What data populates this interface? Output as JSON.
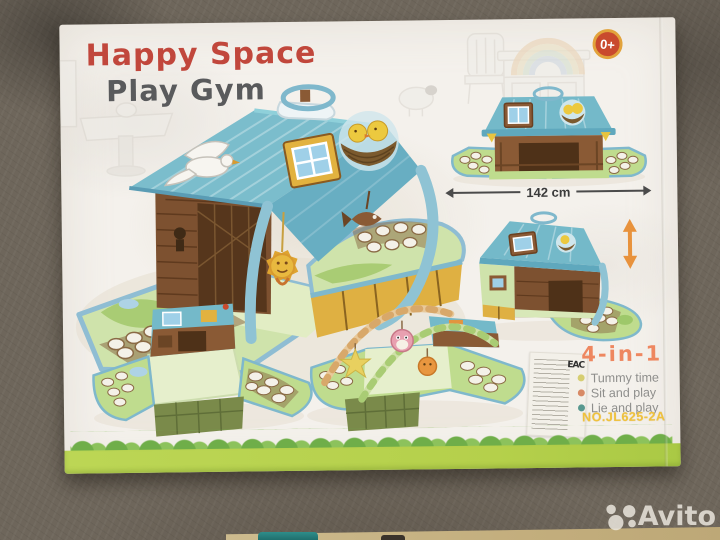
{
  "photo": {
    "watermark_label": "Avito",
    "surface_colors": {
      "carpet": "#6e665b",
      "wood_floor": "#c6b284"
    }
  },
  "box_front": {
    "brand_title": "Happy Space",
    "product_title": "Play Gym",
    "age_badge": "0+",
    "size_label": "142 cm",
    "multi_use_heading": "4-in-1",
    "features": [
      {
        "label": "Tummy time",
        "bullet_color": "#d6ce72"
      },
      {
        "label": "Sit and play",
        "bullet_color": "#d88a66"
      },
      {
        "label": "Lie and play",
        "bullet_color": "#58988f"
      }
    ],
    "model_number": "NO.JL625-2A",
    "sticker_mark": "EAC",
    "colors": {
      "brand_red": "#c1473c",
      "title_gray": "#595a5c",
      "badge_fill": "#c94a2e",
      "badge_ring": "#e2a33c",
      "heading_orange": "#ee8760",
      "model_yellow": "#f0c23c",
      "band_green": "#b5d04b",
      "hedge_green": "#6fae49",
      "roof_blue": "#7bbdcc",
      "mat_green": "#cfe3ab"
    }
  }
}
